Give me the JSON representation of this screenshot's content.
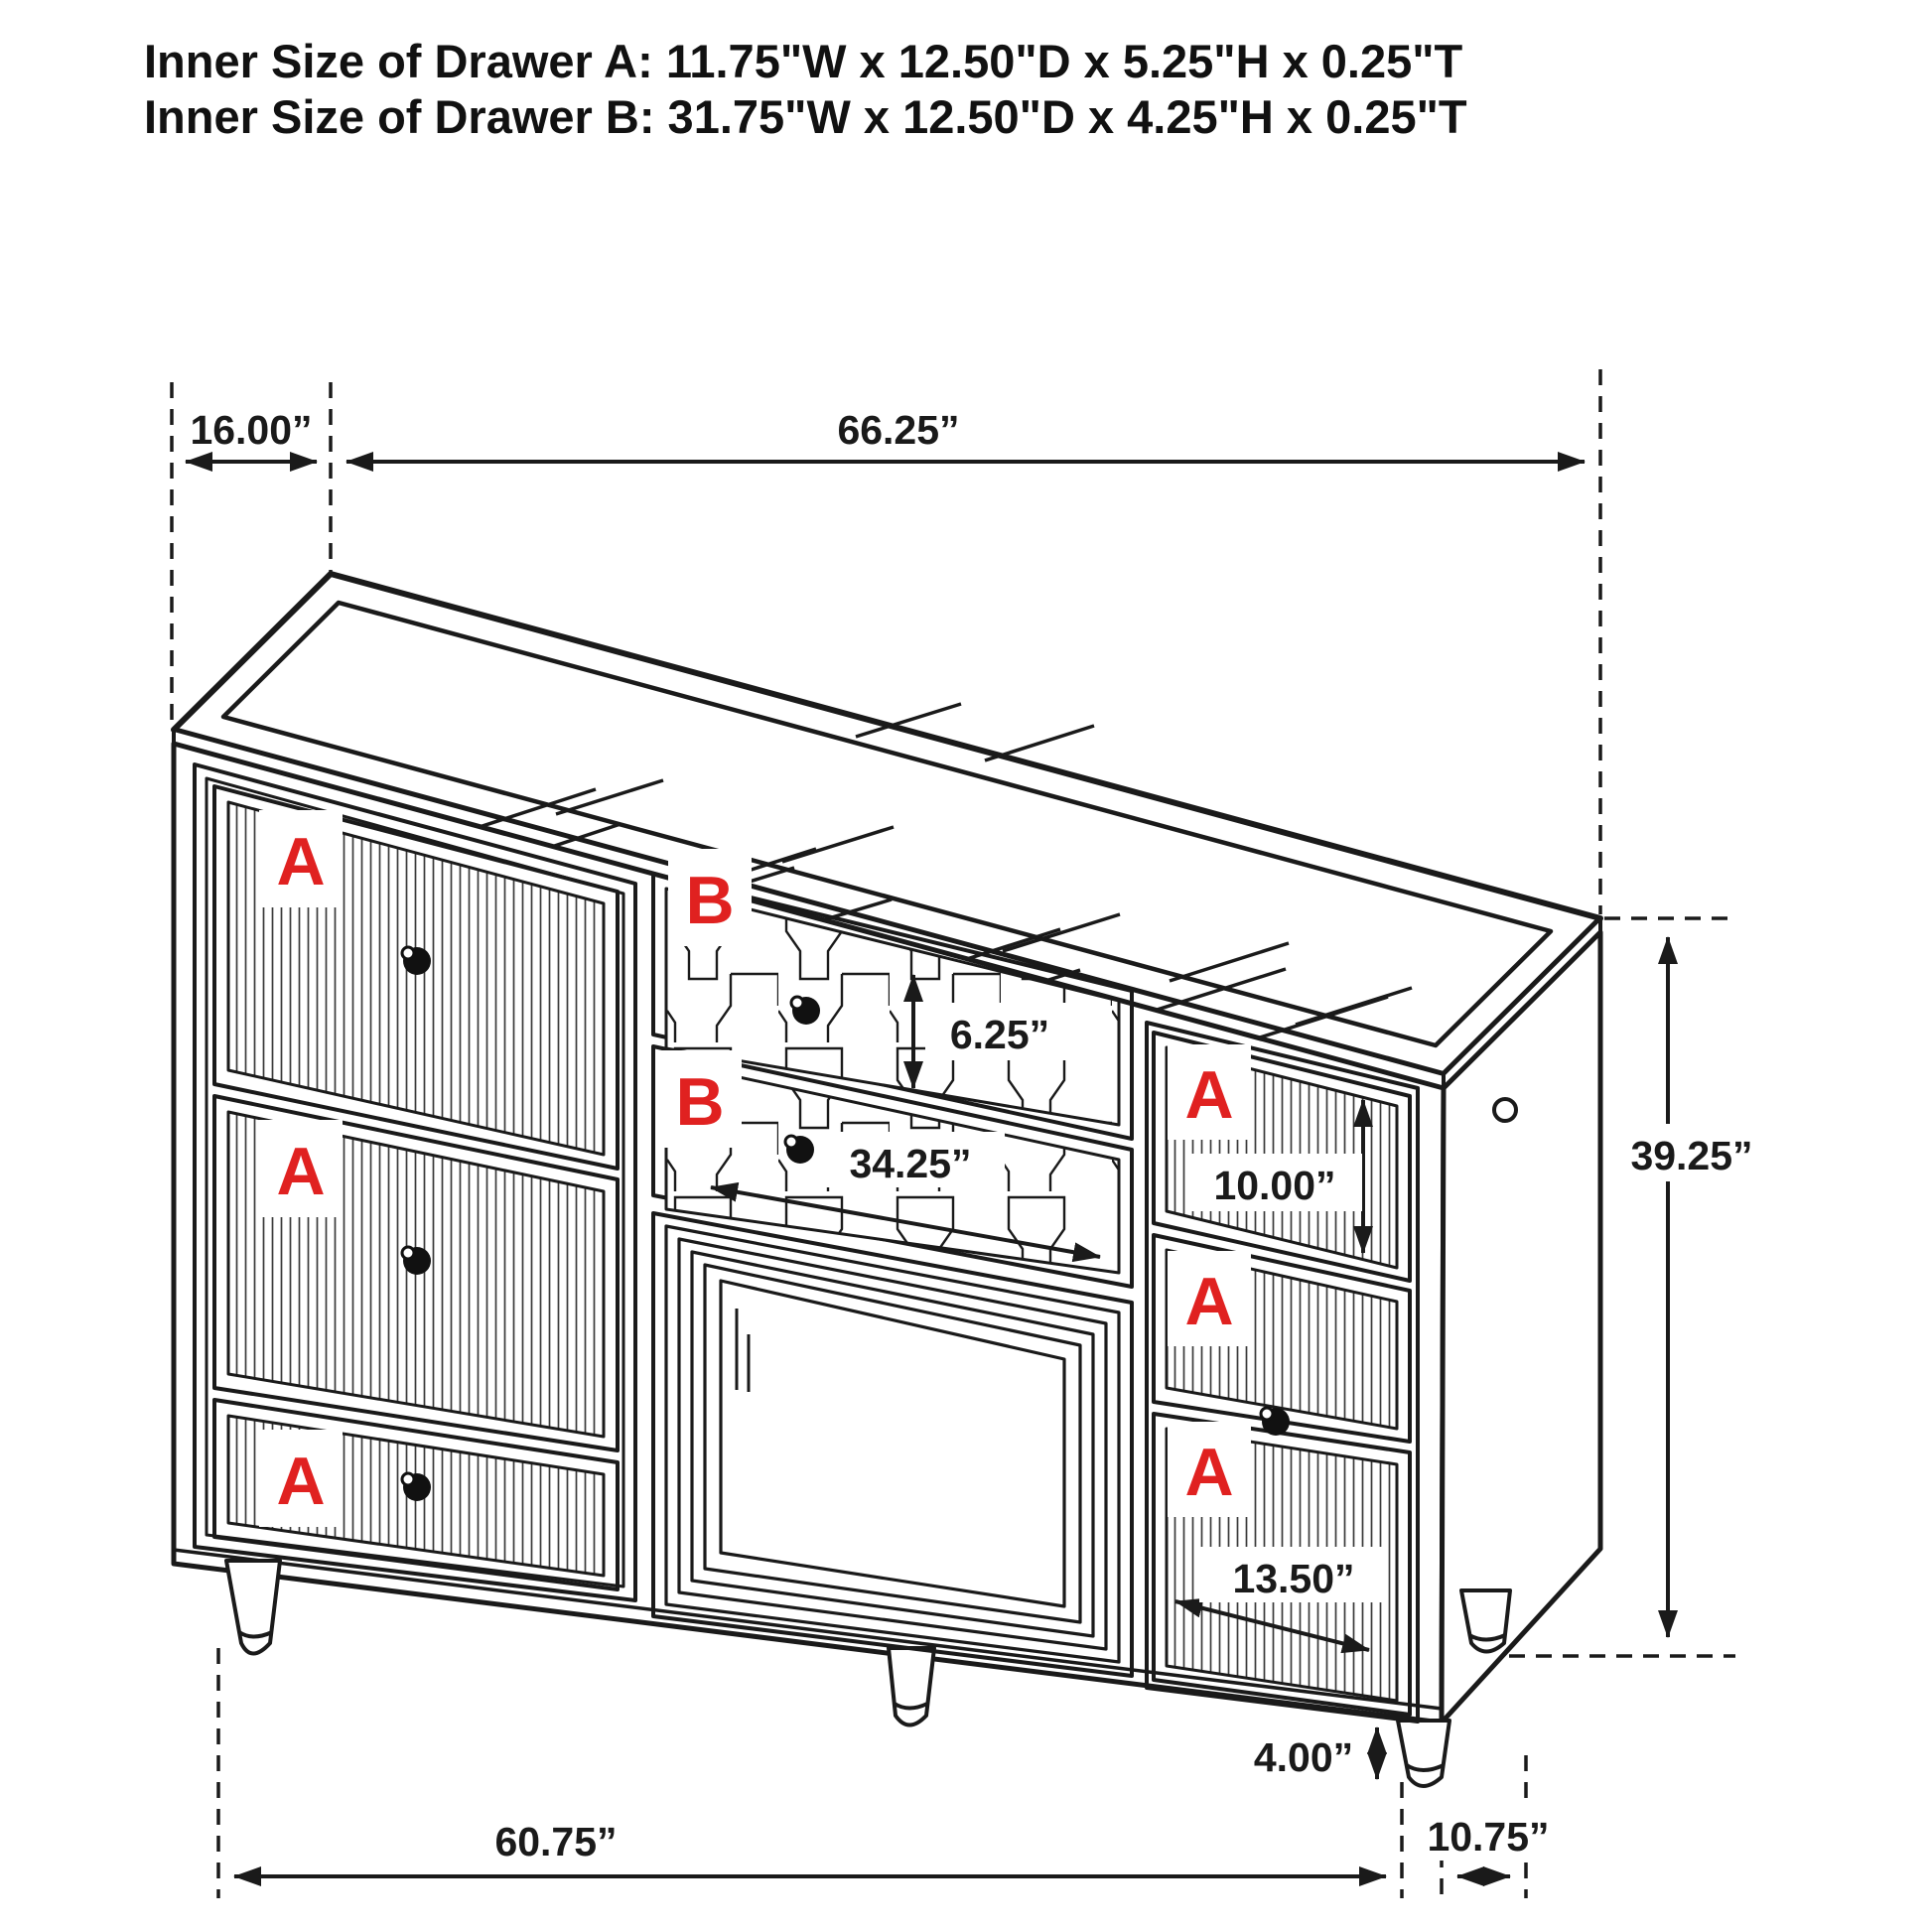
{
  "header": {
    "line1": "Inner Size of Drawer A: 11.75\"W x 12.50\"D x 5.25\"H x 0.25\"T",
    "line2": "Inner Size of Drawer B: 31.75\"W x 12.50\"D x 4.25\"H x 0.25\"T"
  },
  "labels": {
    "drawer_a": "A",
    "drawer_b": "B"
  },
  "dims": {
    "top_depth": "16.00”",
    "top_width": "66.25”",
    "drawer_b_height": "6.25”",
    "drawer_b_width": "34.25”",
    "right_top_drawer_height": "10.00”",
    "overall_height": "39.25”",
    "right_bottom_drawer_width": "13.50”",
    "leg_height": "4.00”",
    "base_width": "60.75”",
    "base_depth": "10.75”"
  },
  "colors": {
    "line": "#1a1a1a",
    "label_red": "#e02120",
    "background": "#ffffff"
  }
}
